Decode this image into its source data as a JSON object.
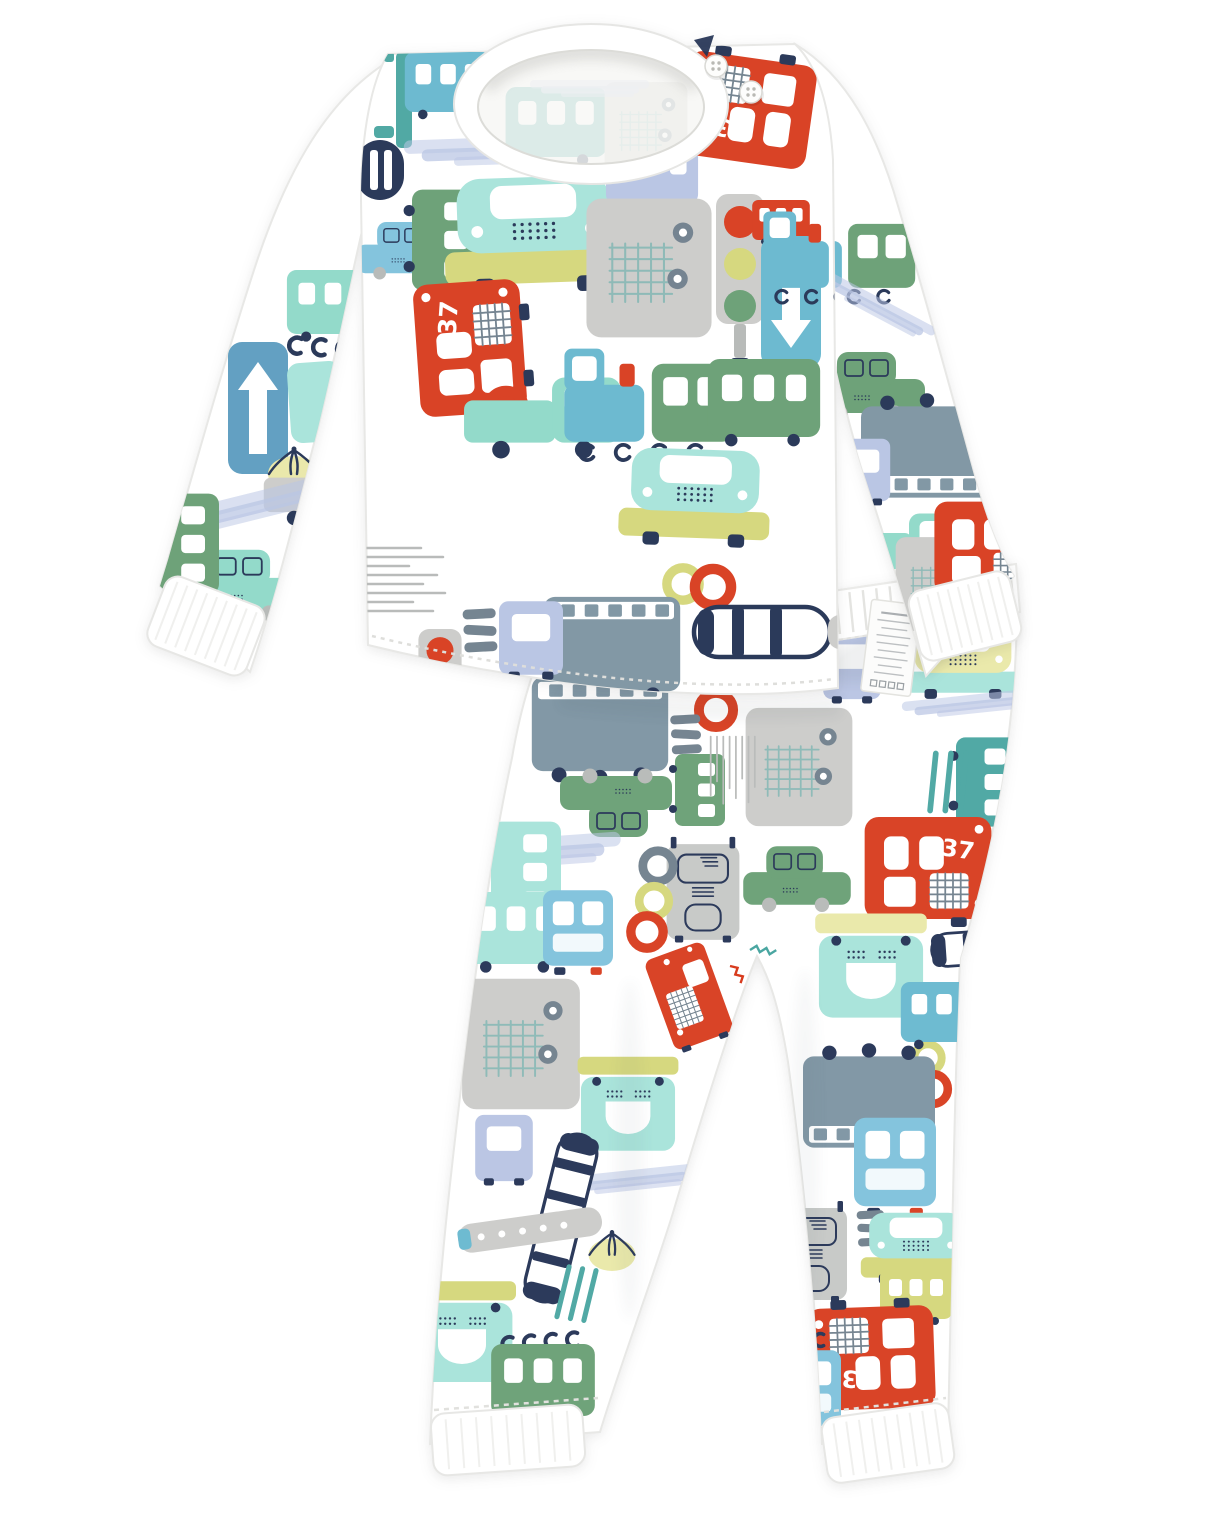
{
  "product": {
    "type": "kids-pajama-two-piece-set",
    "print_theme": "cartoon traffic vehicles",
    "pieces": [
      "long-sleeve-top-with-shoulder-buttons",
      "harem-pants-with-ribbed-cuffs"
    ]
  },
  "labels": {
    "bus_number": "37"
  },
  "care_label": {
    "legible": false,
    "line_count": 9,
    "icon_count": 4
  },
  "palette": {
    "red": "#d83c1e",
    "redDark": "#b5301a",
    "navy": "#233254",
    "slate": "#70808d",
    "slateBlue": "#7d94a2",
    "lightGray": "#cbcbc9",
    "midGray": "#b6b9b7",
    "warmGray": "#c6c8c6",
    "aquaLight": "#a7e3da",
    "mint": "#8fd9c8",
    "teal": "#4aa6a1",
    "tealBlue": "#68b8cf",
    "skyBlue": "#7fc2dc",
    "steelBlue": "#5d9dc0",
    "periwinkle": "#b8c4e3",
    "green": "#699f74",
    "greenLight": "#93c79b",
    "yellowGreen": "#d5d77a",
    "paleYellow": "#eae8a8",
    "white": "#ffffff",
    "stitch": "#dededb",
    "rib": "#f0f0ee",
    "edge": "#e8e8e6",
    "labelText": "#a3a7ab"
  },
  "pattern": {
    "shirt_body": [
      {
        "t": "ladder",
        "x": 404,
        "y": 100,
        "s": 1,
        "r": 0
      },
      {
        "t": "letterD",
        "x": 380,
        "y": 170,
        "s": 1,
        "r": 0
      },
      {
        "t": "carSide",
        "x": 404,
        "y": 248,
        "s": 0.42,
        "r": 0,
        "c": "skyBlue"
      },
      {
        "t": "busSide",
        "x": 447,
        "y": 240,
        "s": 0.7,
        "r": 90,
        "c": "green"
      },
      {
        "t": "carFront",
        "x": 534,
        "y": 228,
        "s": 0.98,
        "r": -2,
        "c": "aquaLight"
      },
      {
        "t": "halfMoon",
        "x": 589,
        "y": 178,
        "s": 1,
        "r": 0
      },
      {
        "t": "busSide",
        "x": 652,
        "y": 172,
        "s": 0.64,
        "r": 0,
        "c": "periwinkle"
      },
      {
        "t": "truckGrid",
        "x": 649,
        "y": 268,
        "s": 0.68,
        "r": 0
      },
      {
        "t": "bus37",
        "x": 747,
        "y": 110,
        "s": 0.9,
        "r": 188
      },
      {
        "t": "trafficLight",
        "x": 740,
        "y": 272,
        "s": 1,
        "r": 0
      },
      {
        "t": "busSide",
        "x": 781,
        "y": 220,
        "s": 0.4,
        "r": 0,
        "c": "red"
      },
      {
        "t": "arrowSign",
        "x": 791,
        "y": 302,
        "s": 1,
        "r": 180,
        "c": "tealBlue"
      },
      {
        "t": "trainTeal",
        "x": 832,
        "y": 252,
        "s": 0.78,
        "r": 0
      },
      {
        "t": "bus37",
        "x": 470,
        "y": 348,
        "s": 0.92,
        "r": -94
      },
      {
        "t": "ring",
        "x": 506,
        "y": 409,
        "s": 0.95,
        "r": 0,
        "c": "red"
      },
      {
        "t": "pickup",
        "x": 545,
        "y": 418,
        "s": 0.88,
        "r": 0,
        "c": "mint"
      },
      {
        "t": "trainTeal",
        "x": 648,
        "y": 398,
        "s": 0.95,
        "r": 0
      },
      {
        "t": "busSide",
        "x": 764,
        "y": 398,
        "s": 0.78,
        "r": 0,
        "c": "green"
      },
      {
        "t": "carFront",
        "x": 695,
        "y": 492,
        "s": 0.82,
        "r": 2,
        "c": "aquaLight"
      },
      {
        "t": "ring",
        "x": 683,
        "y": 584,
        "s": 0.85,
        "r": 0,
        "c": "yellowGreen"
      },
      {
        "t": "ring",
        "x": 713,
        "y": 587,
        "s": 0.95,
        "r": 0,
        "c": "red"
      },
      {
        "t": "truckRear",
        "x": 612,
        "y": 644,
        "s": 0.62,
        "r": 180
      },
      {
        "t": "speedLines",
        "x": 401,
        "y": 582,
        "s": 1,
        "r": 0
      },
      {
        "t": "crosswalk",
        "x": 480,
        "y": 630,
        "s": 0.75,
        "r": 0
      },
      {
        "t": "periTruck",
        "x": 531,
        "y": 638,
        "s": 0.8,
        "r": 0
      },
      {
        "t": "trafficLight",
        "x": 440,
        "y": 674,
        "s": 0.9,
        "r": 0,
        "v": "small"
      },
      {
        "t": "planeH",
        "x": 762,
        "y": 632,
        "s": 1,
        "r": 0
      },
      {
        "t": "smear",
        "x": 500,
        "y": 150,
        "s": 0.8,
        "r": -2,
        "c": "periwinkle"
      },
      {
        "t": "busSide",
        "x": 448,
        "y": 82,
        "s": 0.6,
        "r": 0,
        "c": "tealBlue"
      }
    ],
    "sleeve_left": [
      {
        "t": "busSide",
        "x": 333,
        "y": 302,
        "s": 0.64,
        "r": 0,
        "c": "mint"
      },
      {
        "t": "wheelHooks",
        "x": 331,
        "y": 348,
        "s": 1,
        "r": 4
      },
      {
        "t": "arrowSign",
        "x": 258,
        "y": 408,
        "s": 1,
        "r": 0,
        "c": "steelBlue"
      },
      {
        "t": "aquaRect",
        "x": 316,
        "y": 402,
        "s": 1,
        "r": -4
      },
      {
        "t": "roadDashes",
        "x": 352,
        "y": 428,
        "s": 1,
        "r": 0
      },
      {
        "t": "heli",
        "x": 294,
        "y": 462,
        "s": 1,
        "r": 0
      },
      {
        "t": "pickup",
        "x": 330,
        "y": 492,
        "s": 0.72,
        "r": 0,
        "c": "lightGray"
      },
      {
        "t": "smear",
        "x": 255,
        "y": 505,
        "s": 0.8,
        "r": -14,
        "c": "periwinkle"
      },
      {
        "t": "carSide",
        "x": 242,
        "y": 582,
        "s": 0.52,
        "r": 0,
        "c": "mint"
      },
      {
        "t": "busSide",
        "x": 184,
        "y": 544,
        "s": 0.7,
        "r": 90,
        "c": "green"
      }
    ],
    "sleeve_right": [
      {
        "t": "bus37",
        "x": 747,
        "y": 110,
        "s": 0.9,
        "r": 188
      },
      {
        "t": "trainTeal",
        "x": 845,
        "y": 252,
        "s": 0.78,
        "r": 0
      },
      {
        "t": "smear",
        "x": 876,
        "y": 306,
        "s": 0.55,
        "r": 28,
        "c": "periwinkle"
      },
      {
        "t": "carSide",
        "x": 869,
        "y": 383,
        "s": 0.5,
        "r": 0,
        "c": "green"
      },
      {
        "t": "truckRear",
        "x": 927,
        "y": 452,
        "s": 0.6,
        "r": 0
      },
      {
        "t": "periTruck",
        "x": 863,
        "y": 470,
        "s": 0.68,
        "r": 0
      },
      {
        "t": "crosswalk",
        "x": 843,
        "y": 497,
        "s": 0.62,
        "r": 0
      },
      {
        "t": "pickup",
        "x": 903,
        "y": 548,
        "s": 0.75,
        "r": 0,
        "c": "mint"
      },
      {
        "t": "truckGrid",
        "x": 938,
        "y": 584,
        "s": 0.46,
        "r": 0
      },
      {
        "t": "bus37",
        "x": 992,
        "y": 548,
        "s": 0.8,
        "r": 0
      }
    ],
    "pants": [
      {
        "t": "busSide",
        "x": 874,
        "y": 597,
        "s": 0.55,
        "r": 0,
        "c": "green"
      },
      {
        "t": "periTruck",
        "x": 852,
        "y": 666,
        "s": 0.72,
        "r": 0
      },
      {
        "t": "carFront",
        "x": 963,
        "y": 658,
        "s": 0.62,
        "r": 0,
        "c": "paleYellow"
      },
      {
        "t": "smear",
        "x": 968,
        "y": 704,
        "s": 0.55,
        "r": -6,
        "c": "periwinkle"
      },
      {
        "t": "busSide",
        "x": 987,
        "y": 782,
        "s": 0.62,
        "r": 90,
        "c": "teal"
      },
      {
        "t": "tealDashes",
        "x": 951,
        "y": 782,
        "s": 0.95,
        "r": 0
      },
      {
        "t": "truckRear",
        "x": 600,
        "y": 724,
        "s": 0.62,
        "r": 180
      },
      {
        "t": "ring",
        "x": 716,
        "y": 710,
        "s": 0.9,
        "r": 0,
        "c": "red"
      },
      {
        "t": "crosswalk",
        "x": 686,
        "y": 734,
        "s": 0.68,
        "r": 0
      },
      {
        "t": "truckGrid",
        "x": 799,
        "y": 767,
        "s": 0.58,
        "r": 0
      },
      {
        "t": "carSide",
        "x": 616,
        "y": 806,
        "s": 0.5,
        "r": 180,
        "c": "green"
      },
      {
        "t": "busSide",
        "x": 700,
        "y": 790,
        "s": 0.5,
        "r": 90,
        "c": "green"
      },
      {
        "t": "speedLines",
        "x": 731,
        "y": 773,
        "s": 0.7,
        "r": 90
      },
      {
        "t": "smear",
        "x": 521,
        "y": 852,
        "s": 0.85,
        "r": -4,
        "c": "periwinkle"
      },
      {
        "t": "busSide",
        "x": 526,
        "y": 872,
        "s": 0.7,
        "r": 90,
        "c": "aquaLight"
      },
      {
        "t": "bus37",
        "x": 928,
        "y": 868,
        "s": 0.88,
        "r": 0
      },
      {
        "t": "carSide",
        "x": 797,
        "y": 876,
        "s": 0.48,
        "r": 0,
        "c": "green"
      },
      {
        "t": "truckFace",
        "x": 703,
        "y": 892,
        "s": 0.52,
        "r": 0
      },
      {
        "t": "ring",
        "x": 658,
        "y": 866,
        "s": 0.8,
        "r": 0,
        "c": "slate"
      },
      {
        "t": "ring",
        "x": 654,
        "y": 901,
        "s": 0.78,
        "r": 0,
        "c": "yellowGreen"
      },
      {
        "t": "ring",
        "x": 647,
        "y": 932,
        "s": 0.85,
        "r": 0,
        "c": "red"
      },
      {
        "t": "busSide",
        "x": 516,
        "y": 928,
        "s": 0.72,
        "r": 0,
        "c": "aquaLight"
      },
      {
        "t": "busFrontBlue",
        "x": 578,
        "y": 928,
        "s": 0.7,
        "r": 0
      },
      {
        "t": "firetruck",
        "x": 689,
        "y": 996,
        "s": 0.52,
        "r": -20
      },
      {
        "t": "busFace",
        "x": 871,
        "y": 968,
        "s": 0.62,
        "r": 0,
        "c": "paleYellow"
      },
      {
        "t": "planeCapsule",
        "x": 1003,
        "y": 946,
        "s": 0.55,
        "r": 86
      },
      {
        "t": "ring",
        "x": 928,
        "y": 1058,
        "s": 0.72,
        "r": 0,
        "c": "yellowGreen"
      },
      {
        "t": "ring",
        "x": 933,
        "y": 1089,
        "s": 0.78,
        "r": 0,
        "c": "red"
      },
      {
        "t": "busSide",
        "x": 944,
        "y": 1012,
        "s": 0.6,
        "r": 0,
        "c": "tealBlue"
      },
      {
        "t": "truckGrid",
        "x": 521,
        "y": 1044,
        "s": 0.64,
        "r": 0
      },
      {
        "t": "busFace",
        "x": 628,
        "y": 1106,
        "s": 0.56,
        "r": 0,
        "c": "yellowGreen"
      },
      {
        "t": "periTruck",
        "x": 504,
        "y": 1148,
        "s": 0.72,
        "r": 0
      },
      {
        "t": "smear",
        "x": 628,
        "y": 1180,
        "s": 0.6,
        "r": -6,
        "c": "periwinkle"
      },
      {
        "t": "planeCapsule",
        "x": 561,
        "y": 1218,
        "s": 0.66,
        "r": 14
      },
      {
        "t": "wingGray",
        "x": 530,
        "y": 1230,
        "s": 0.58,
        "r": -8
      },
      {
        "t": "heli",
        "x": 612,
        "y": 1244,
        "s": 0.9,
        "r": 0
      },
      {
        "t": "tealDashes",
        "x": 579,
        "y": 1294,
        "s": 0.85,
        "r": 8
      },
      {
        "t": "busFace",
        "x": 462,
        "y": 1334,
        "s": 0.6,
        "r": 0,
        "c": "yellowGreen"
      },
      {
        "t": "wheelHooks",
        "x": 540,
        "y": 1342,
        "s": 0.9,
        "r": -4
      },
      {
        "t": "busSide",
        "x": 543,
        "y": 1380,
        "s": 0.72,
        "r": 0,
        "c": "green"
      },
      {
        "t": "truckRear",
        "x": 869,
        "y": 1102,
        "s": 0.6,
        "r": 0
      },
      {
        "t": "busFrontBlue",
        "x": 895,
        "y": 1162,
        "s": 0.82,
        "r": 0
      },
      {
        "t": "truckFace",
        "x": 812,
        "y": 1254,
        "s": 0.5,
        "r": 0
      },
      {
        "t": "crosswalk",
        "x": 871,
        "y": 1228,
        "s": 0.62,
        "r": 0
      },
      {
        "t": "carFront",
        "x": 916,
        "y": 1244,
        "s": 0.6,
        "r": 0,
        "c": "aquaLight"
      },
      {
        "t": "busSide",
        "x": 916,
        "y": 1294,
        "s": 0.5,
        "r": 0,
        "c": "yellowGreen"
      },
      {
        "t": "tealDashes",
        "x": 801,
        "y": 1324,
        "s": 0.7,
        "r": 90
      },
      {
        "t": "bus37",
        "x": 871,
        "y": 1358,
        "s": 0.88,
        "r": 178
      },
      {
        "t": "busFrontBlue",
        "x": 806,
        "y": 1388,
        "s": 0.7,
        "r": 0
      },
      {
        "t": "wheelHooks",
        "x": 790,
        "y": 1340,
        "s": 0.8,
        "r": 0
      }
    ],
    "collar_inner": [
      {
        "t": "busSide",
        "x": 556,
        "y": 122,
        "s": 0.7,
        "r": 0,
        "c": "teal"
      },
      {
        "t": "truckGrid",
        "x": 646,
        "y": 128,
        "s": 0.45,
        "r": 0
      },
      {
        "t": "smear",
        "x": 590,
        "y": 88,
        "s": 0.5,
        "r": 0,
        "c": "periwinkle"
      }
    ]
  }
}
